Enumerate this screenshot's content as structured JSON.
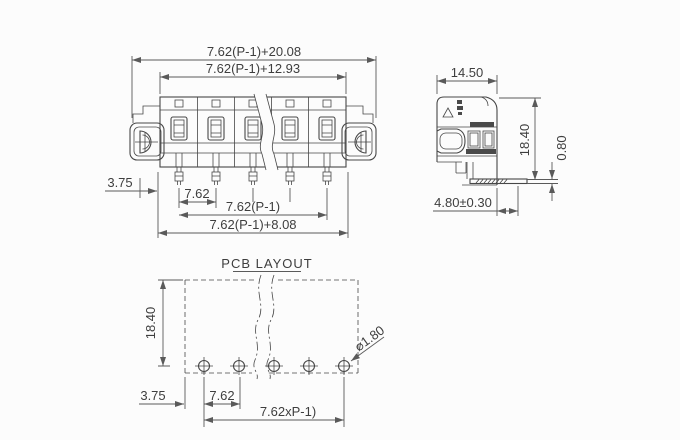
{
  "drawing": {
    "type": "connector-dimension-drawing",
    "background": "#fcfcfc",
    "line_color": "#474747",
    "dim_color": "#5a5a5a",
    "front_view": {
      "positions": 5,
      "dim_overall": "7.62(P-1)+20.08",
      "dim_body": "7.62(P-1)+12.93",
      "dim_offset": "3.75",
      "dim_pitch": "7.62",
      "dim_pitch_span": "7.62(P-1)",
      "dim_pin_span": "7.62(P-1)+8.08"
    },
    "side_view": {
      "dim_depth": "14.50",
      "dim_height": "18.40",
      "dim_pin_thickness": "0.80",
      "dim_pin_length": "4.80±0.30"
    },
    "pcb_layout": {
      "title": "PCB LAYOUT",
      "hole_count": 5,
      "dim_height": "18.40",
      "dim_offset": "3.75",
      "dim_pitch": "7.62",
      "dim_span": "7.62xP-1)",
      "dim_hole_diameter": "⌀1.80"
    }
  }
}
